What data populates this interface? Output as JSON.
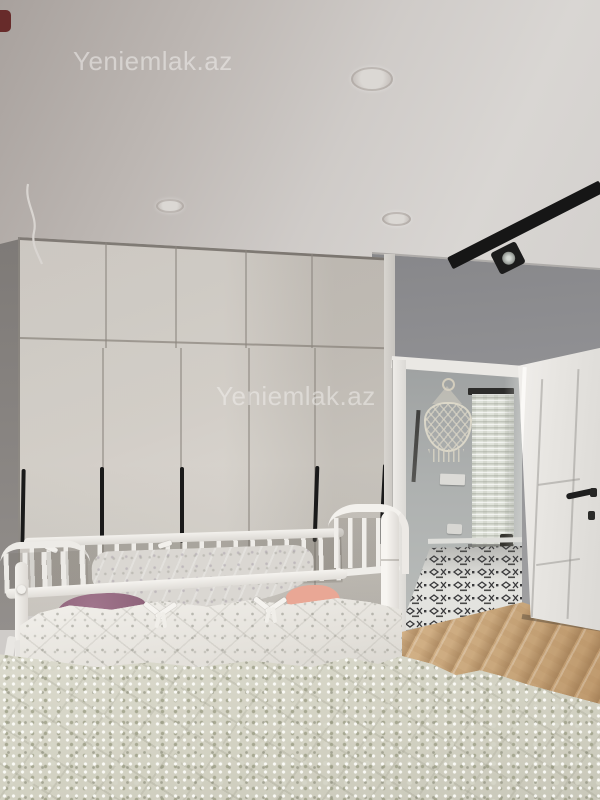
{
  "scene": {
    "description": "Real-estate listing photo of a bedroom with a large wardrobe, baby crib, bed and an open door to a hallway",
    "room": "bedroom"
  },
  "watermarks": [
    {
      "text": "Yeniemlak.az"
    },
    {
      "text": "Yeniemlak.az"
    }
  ],
  "colors": {
    "ceiling": "#cfccc9",
    "right_wall": "#97979a",
    "left_wall": "#837f7c",
    "wardrobe": "#cdc8c1",
    "wardrobe_handles": "#1a1a1a",
    "track_light": "#161616",
    "door": "#eae8e5",
    "door_handle": "#1e1e1e",
    "hallway_wall": "#aeb1b0",
    "stone_accent": "#e0e3db",
    "tile_dark": "#39393b",
    "tile_light": "#e3e3df",
    "wood_floor": "#c9a77c",
    "crib": "#f0eeea",
    "crib_bumper": "#e9e6e1",
    "blanket_plum": "#9b7086",
    "blanket_pink": "#e9a795",
    "bedspread": "#d6d5c8"
  }
}
